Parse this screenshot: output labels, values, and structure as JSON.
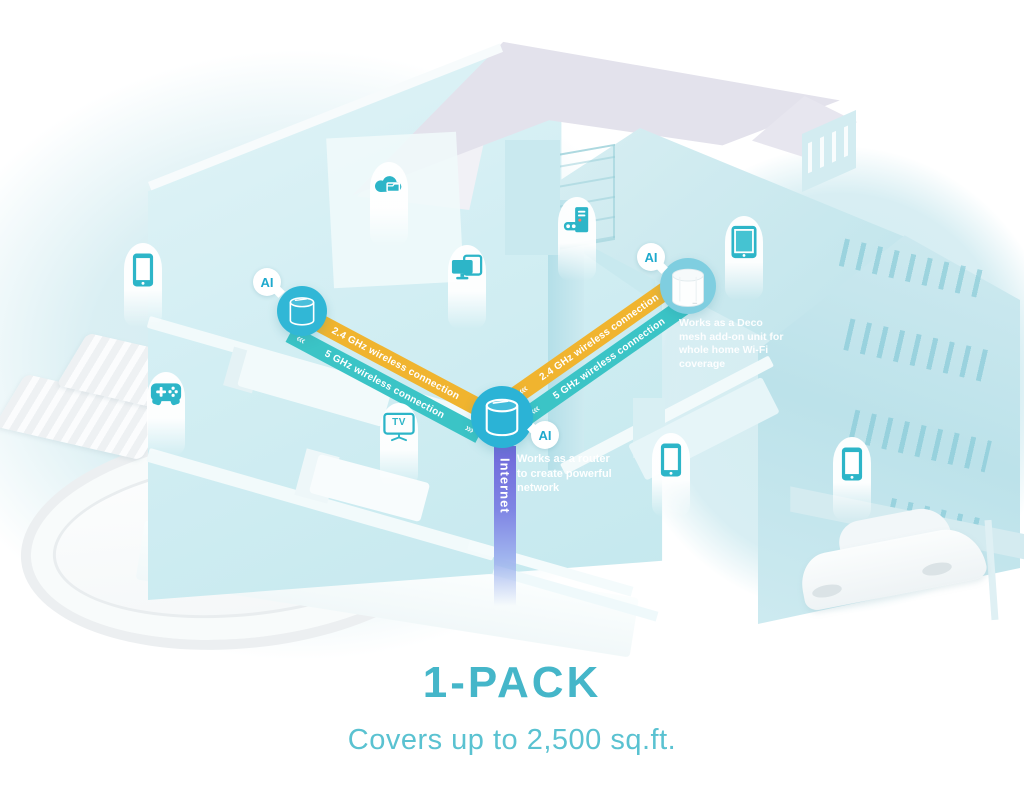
{
  "illustration": {
    "internet": {
      "label": "Internet"
    },
    "bands": {
      "label_24": "2.4 GHz wireless connection",
      "label_5": "5 GHz wireless connection",
      "chevrons_back": "‹‹‹",
      "chevrons_forward": "›››"
    },
    "units": {
      "left_ai": "AI",
      "main_ai": "AI",
      "addon_ai": "AI",
      "main_caption": "Works as a router to create powerful network",
      "addon_caption": "Works as a Deco mesh add-on unit for whole home Wi-Fi coverage"
    },
    "devices": {
      "tv_label": "TV",
      "icons": [
        "smartphone",
        "gamepad",
        "cloud-storage",
        "desktop-computer",
        "pc-vr-headset",
        "tv",
        "tablet",
        "smartphone",
        "smartphone"
      ]
    }
  },
  "footer": {
    "title": "1-PACK",
    "subtitle": "Covers up to 2,500 sq.ft."
  },
  "colors": {
    "band_2_4ghz": "#f0b42f",
    "band_5ghz": "#3bc4c6",
    "unit_circle_teal": "#2bb3d6",
    "addon_ring": "#7fcee0",
    "ai_text": "#1ea9cd",
    "device_icon": "#2db5c8",
    "internet_top": "#6f68da",
    "internet_mid": "#7f85e4",
    "title_teal": "#45b6c9",
    "subtitle_teal": "#5ac2d1",
    "house_tint": "#d2eef3",
    "roof_grey": "#e3e2ec"
  }
}
